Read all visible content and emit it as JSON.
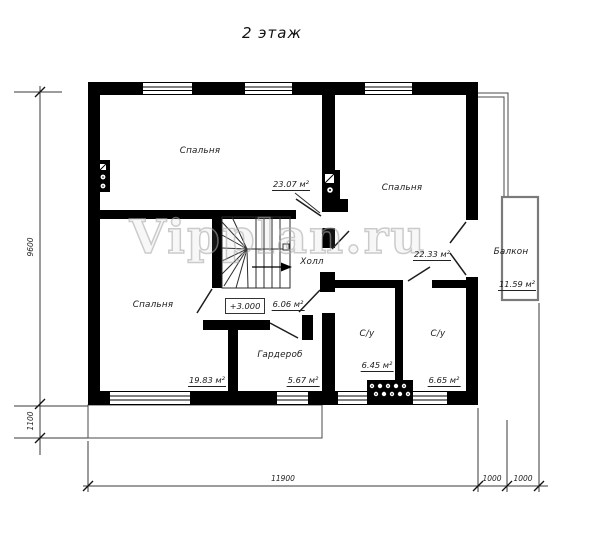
{
  "title": "2 этаж",
  "watermark": "Vipplan.ru",
  "elevation": "+3.000",
  "rooms": {
    "bedroom_tl": {
      "name": "Спальня",
      "area": "23.07 м²"
    },
    "bedroom_tr": {
      "name": "Спальня",
      "area": "22.33 м²"
    },
    "bedroom_bl": {
      "name": "Спальня",
      "area": "19.83 м²"
    },
    "hall": {
      "name": "Холл",
      "area": "6.06 м²"
    },
    "wardrobe": {
      "name": "Гардероб",
      "area": "5.67 м²"
    },
    "bath_left": {
      "name": "С/у",
      "area": "6.45 м²"
    },
    "bath_right": {
      "name": "С/у",
      "area": "6.65 м²"
    },
    "balcony": {
      "name": "Балкон",
      "area": "11.59 м²"
    }
  },
  "dimensions": {
    "left_height": "9600",
    "left_porch": "1100",
    "bottom_width": "11900",
    "balcony_depth_1": "1000",
    "balcony_depth_2": "1000"
  },
  "colors": {
    "wall": "#000000",
    "line": "#2b2b2b",
    "watermark": "#a9a9a9"
  }
}
